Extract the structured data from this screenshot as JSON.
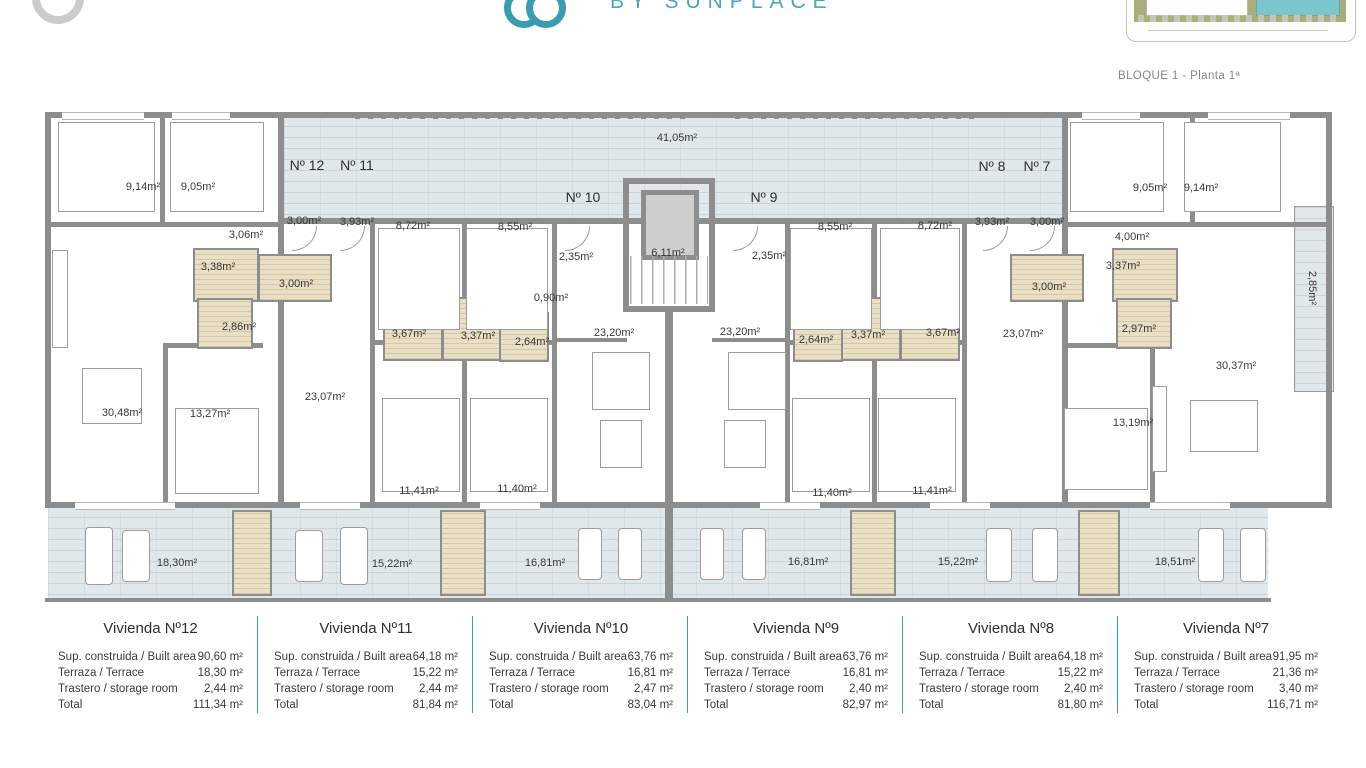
{
  "header": {
    "brand_sub": "BY SUNPLACE",
    "plan_title": "BLOQUE 1 - Planta 1ª",
    "brand_color": "#4aa6ba",
    "pool_color": "#7cc5cd",
    "green_color": "#a9ad7c"
  },
  "plan": {
    "wall_color": "#8d8d8d",
    "terrace_color": "#e1e8eb",
    "bathroom_color": "#e9dfc4",
    "vertical_label": {
      "text": "2,85m²",
      "x": 1295,
      "y": 282
    },
    "unit_labels": [
      {
        "text": "Nº 12",
        "x": 307,
        "y": 157
      },
      {
        "text": "Nº 11",
        "x": 357,
        "y": 157
      },
      {
        "text": "Nº 10",
        "x": 583,
        "y": 189
      },
      {
        "text": "Nº 9",
        "x": 764,
        "y": 189
      },
      {
        "text": "Nº 8",
        "x": 992,
        "y": 158
      },
      {
        "text": "Nº 7",
        "x": 1037,
        "y": 158
      }
    ],
    "labels": [
      {
        "text": "9,14m²",
        "x": 143,
        "y": 181
      },
      {
        "text": "9,05m²",
        "x": 198,
        "y": 181
      },
      {
        "text": "3,06m²",
        "x": 246,
        "y": 229
      },
      {
        "text": "3,00m²",
        "x": 304,
        "y": 215
      },
      {
        "text": "3,93m²",
        "x": 357,
        "y": 216
      },
      {
        "text": "3,38m²",
        "x": 218,
        "y": 261
      },
      {
        "text": "3,00m²",
        "x": 296,
        "y": 278
      },
      {
        "text": "2,86m²",
        "x": 239,
        "y": 321
      },
      {
        "text": "8,72m²",
        "x": 413,
        "y": 220
      },
      {
        "text": "8,55m²",
        "x": 515,
        "y": 221
      },
      {
        "text": "2,35m²",
        "x": 576,
        "y": 251
      },
      {
        "text": "0,90m²",
        "x": 551,
        "y": 292
      },
      {
        "text": "3,67m²",
        "x": 409,
        "y": 328
      },
      {
        "text": "3,37m²",
        "x": 478,
        "y": 330
      },
      {
        "text": "2,64m²",
        "x": 532,
        "y": 336
      },
      {
        "text": "41,05m²",
        "x": 677,
        "y": 132
      },
      {
        "text": "6,11m²",
        "x": 668,
        "y": 247
      },
      {
        "text": "2,35m²",
        "x": 769,
        "y": 250
      },
      {
        "text": "8,55m²",
        "x": 835,
        "y": 221
      },
      {
        "text": "23,20m²",
        "x": 614,
        "y": 327
      },
      {
        "text": "23,20m²",
        "x": 740,
        "y": 326
      },
      {
        "text": "2,64m²",
        "x": 816,
        "y": 334
      },
      {
        "text": "3,37m²",
        "x": 868,
        "y": 329
      },
      {
        "text": "3,67m²",
        "x": 943,
        "y": 327
      },
      {
        "text": "8,72m²",
        "x": 935,
        "y": 220
      },
      {
        "text": "3,93m²",
        "x": 992,
        "y": 216
      },
      {
        "text": "3,00m²",
        "x": 1047,
        "y": 216
      },
      {
        "text": "9,05m²",
        "x": 1150,
        "y": 182
      },
      {
        "text": "9,14m²",
        "x": 1201,
        "y": 182
      },
      {
        "text": "4,00m²",
        "x": 1132,
        "y": 231
      },
      {
        "text": "3,37m²",
        "x": 1123,
        "y": 260
      },
      {
        "text": "3,00m²",
        "x": 1049,
        "y": 281
      },
      {
        "text": "23,07m²",
        "x": 1023,
        "y": 328
      },
      {
        "text": "2,97m²",
        "x": 1139,
        "y": 323
      },
      {
        "text": "30,48m²",
        "x": 122,
        "y": 407
      },
      {
        "text": "13,27m²",
        "x": 210,
        "y": 408
      },
      {
        "text": "23,07m²",
        "x": 325,
        "y": 391
      },
      {
        "text": "11,41m²",
        "x": 419,
        "y": 485
      },
      {
        "text": "11,40m²",
        "x": 517,
        "y": 483
      },
      {
        "text": "11,40m²",
        "x": 832,
        "y": 487
      },
      {
        "text": "11,41m²",
        "x": 932,
        "y": 485
      },
      {
        "text": "13,19m²",
        "x": 1133,
        "y": 417
      },
      {
        "text": "30,37m²",
        "x": 1236,
        "y": 360
      },
      {
        "text": "18,30m²",
        "x": 177,
        "y": 557
      },
      {
        "text": "15,22m²",
        "x": 392,
        "y": 558
      },
      {
        "text": "16,81m²",
        "x": 545,
        "y": 557
      },
      {
        "text": "16,81m²",
        "x": 808,
        "y": 556
      },
      {
        "text": "15,22m²",
        "x": 958,
        "y": 556
      },
      {
        "text": "18,51m²",
        "x": 1175,
        "y": 556
      }
    ]
  },
  "table": {
    "divider_color": "#3aa0b5",
    "row_labels": {
      "built": "Sup. construida / Built area",
      "terrace": "Terraza / Terrace",
      "storage": "Trastero / storage room",
      "total": "Total"
    },
    "columns": [
      {
        "title": "Vivienda Nº12",
        "built": "90,60 m²",
        "terrace": "18,30 m²",
        "storage": "2,44 m²",
        "total": "111,34 m²"
      },
      {
        "title": "Vivienda Nº11",
        "built": "64,18 m²",
        "terrace": "15,22 m²",
        "storage": "2,44 m²",
        "total": "81,84 m²"
      },
      {
        "title": "Vivienda Nº10",
        "built": "63,76 m²",
        "terrace": "16,81 m²",
        "storage": "2,47 m²",
        "total": "83,04 m²"
      },
      {
        "title": "Vivienda Nº9",
        "built": "63,76 m²",
        "terrace": "16,81 m²",
        "storage": "2,40 m²",
        "total": "82,97 m²"
      },
      {
        "title": "Vivienda Nº8",
        "built": "64,18 m²",
        "terrace": "15,22 m²",
        "storage": "2,40 m²",
        "total": "81,80 m²"
      },
      {
        "title": "Vivienda Nº7",
        "built": "91,95 m²",
        "terrace": "21,36 m²",
        "storage": "3,40 m²",
        "total": "116,71 m²"
      }
    ]
  }
}
